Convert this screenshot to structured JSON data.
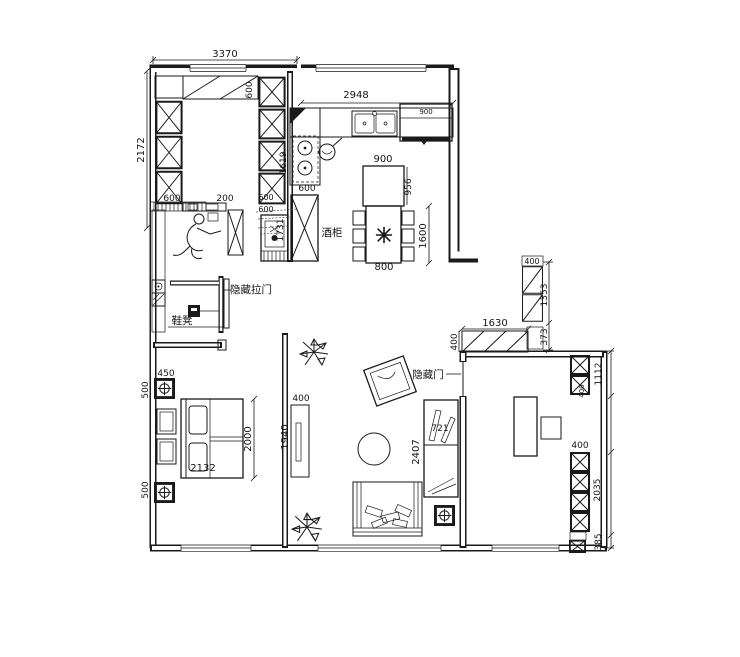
{
  "drawing": {
    "background": "#ffffff",
    "line_color": "#1a1a1a"
  },
  "cloakroom": {
    "width": "3370",
    "depth": "2172",
    "top_cab": "600",
    "left_cab": "600",
    "gap": "200",
    "right_cab_a": "600",
    "right_cab_b": "600",
    "utility_col": "1731"
  },
  "kitchen": {
    "window_width": "2948",
    "left_run": "1619",
    "left_cab": "600",
    "wine_cabinet": "酒柜",
    "island_w": "900",
    "island_d": "956",
    "fridge": "900",
    "table_len": "1600",
    "table_w": "800"
  },
  "entry": {
    "hidden_sliding_door": "隐藏拉门",
    "shoe_bench": "鞋凳"
  },
  "corridor": {
    "cab_depth": "400",
    "cab_h": "1353",
    "gap": "373",
    "wardrobe_w": "1630",
    "wardrobe_d": "400"
  },
  "living": {
    "hidden_door": "隐藏门",
    "shelf_d": "721",
    "wall_len": "2407",
    "divider_d": "400",
    "divider_len": "1940"
  },
  "bedroom_left": {
    "bed_w": "2132",
    "bed_len": "2000",
    "stand_w": "450",
    "stand_d1": "500",
    "stand_d2": "500"
  },
  "bedroom_right": {
    "cab1_h": "1112",
    "cab1_d": "400",
    "cab2_d": "400",
    "cab2_h": "2035",
    "gap": "385"
  }
}
